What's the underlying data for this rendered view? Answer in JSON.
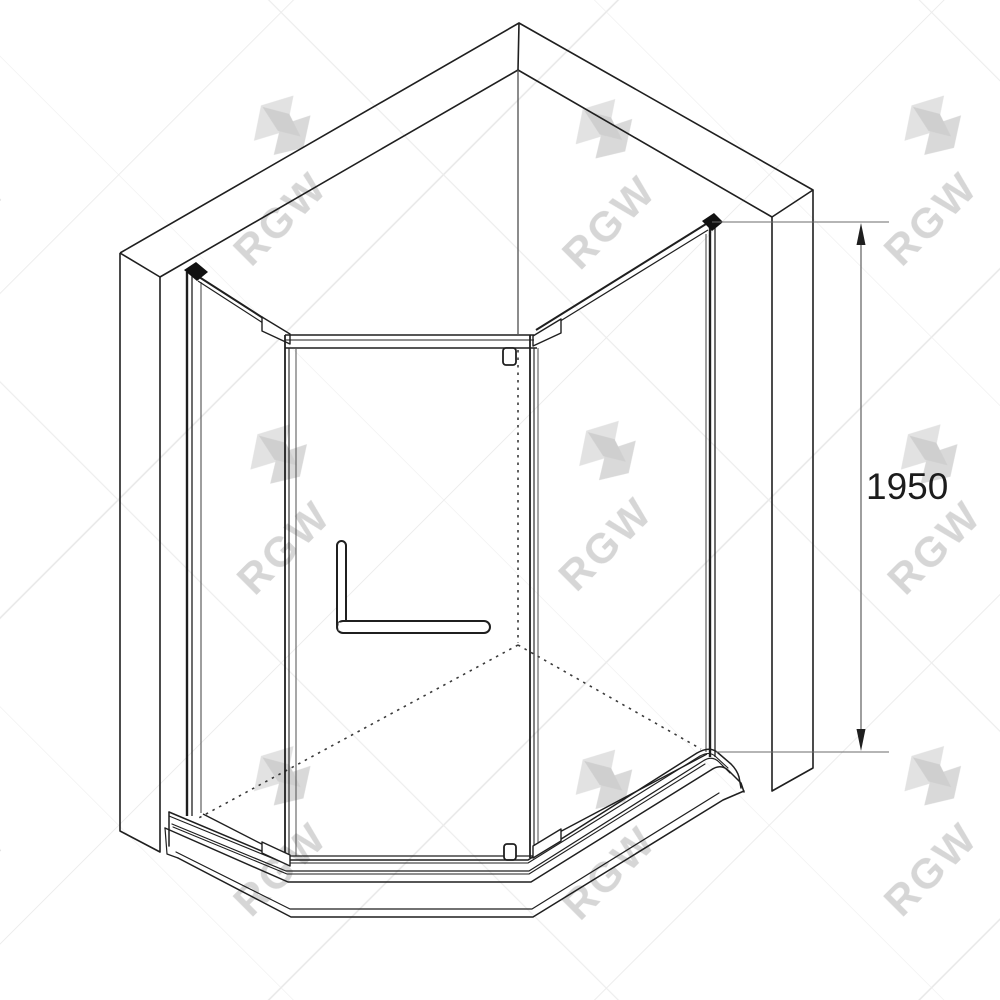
{
  "meta": {
    "drawing_type": "isometric technical line drawing",
    "subject": "neo-angle corner shower enclosure with pentagonal tray"
  },
  "dimension": {
    "height_label": "1950"
  },
  "watermark": {
    "text": "RGW"
  },
  "colors": {
    "background": "#ffffff",
    "main_line": "#1f1f1f",
    "thin_line": "#5a5a5a",
    "dimension_line": "#6b6b6b",
    "dimension_text": "#1c1c1c",
    "watermark": "#d6d6d6"
  }
}
